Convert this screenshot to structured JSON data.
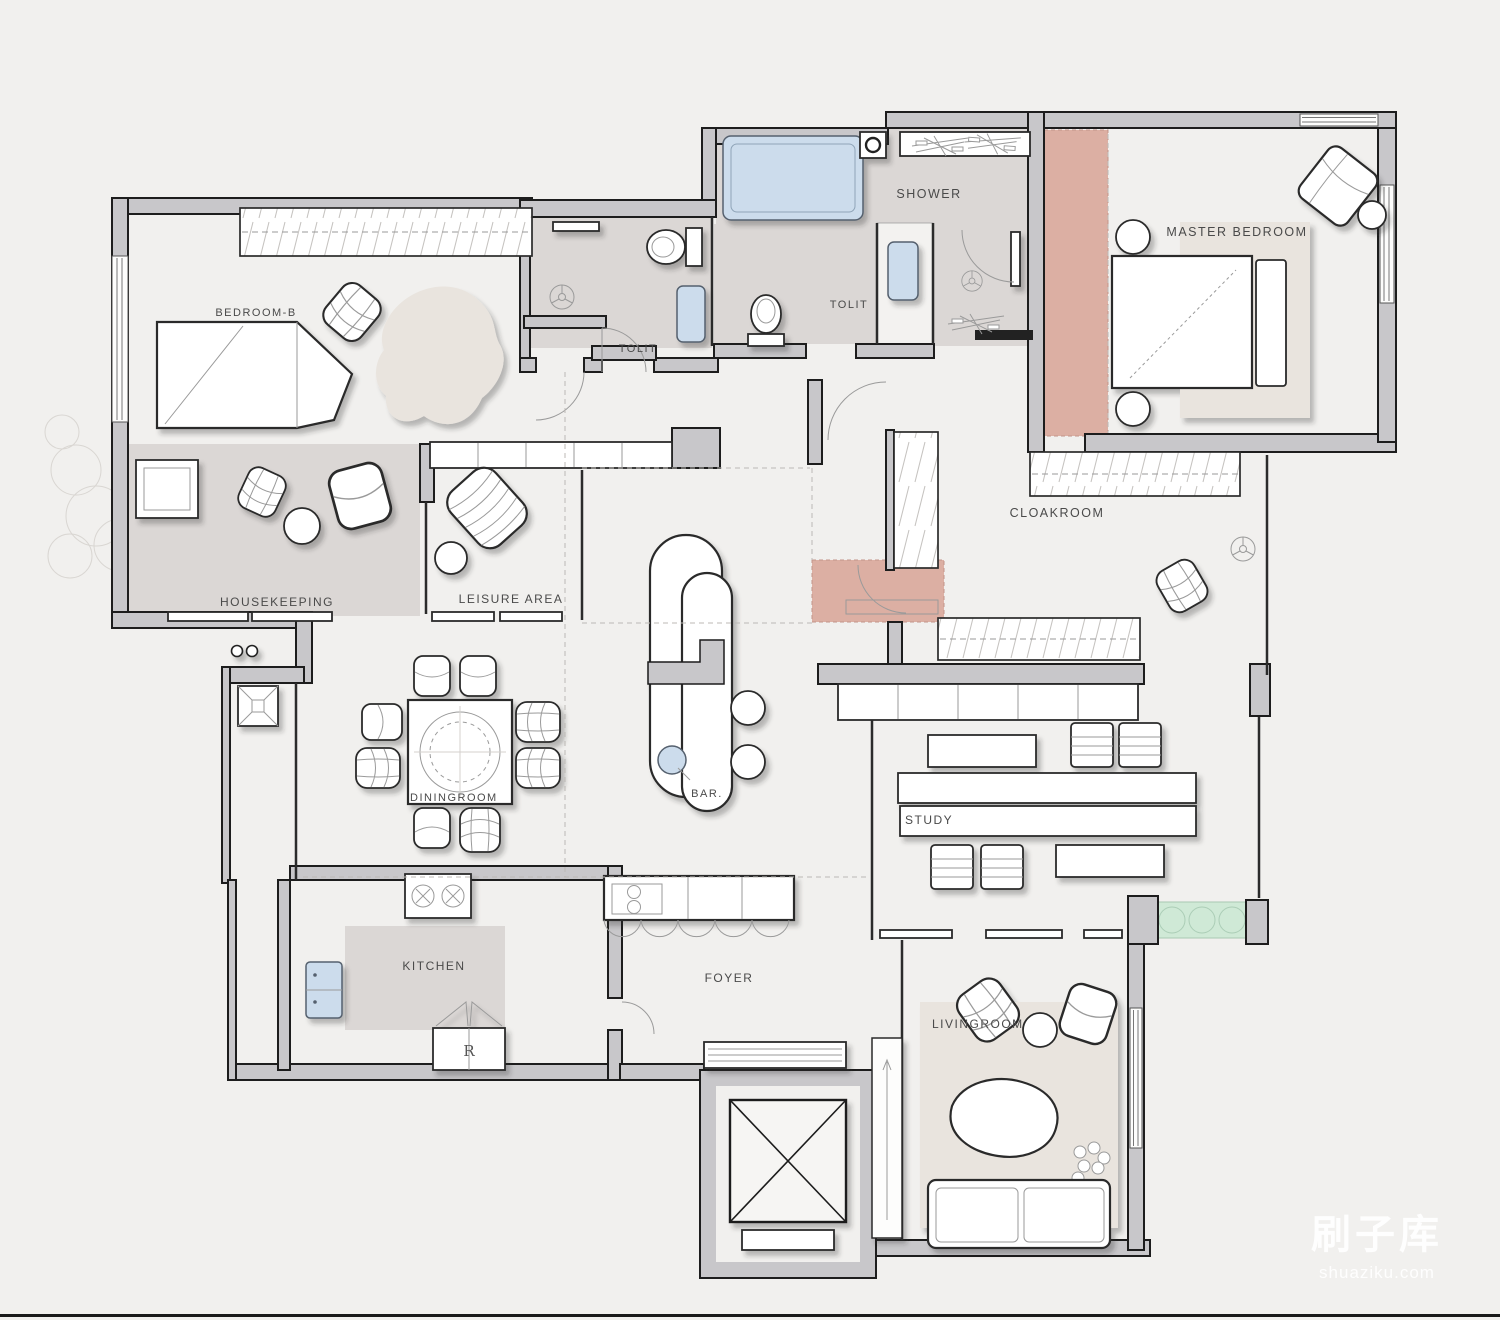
{
  "page": {
    "kind": "apartment-floor-plan",
    "background": "#f1f0ee"
  },
  "watermark": {
    "brand": "刷子库",
    "site": "shuaziku.com"
  },
  "rooms": {
    "bedroom_b": "BEDROOM-B",
    "tolit_a": "TOLIT",
    "tolit_b": "TOLIT",
    "shower": "SHOWER",
    "master_bedroom": "MASTER BEDROOM",
    "housekeeping": "HOUSEKEEPING",
    "leisure_area": "LEISURE AREA",
    "cloakroom": "CLOAKROOM",
    "diningroom": "DININGROOM",
    "bar": "BAR.",
    "study": "STUDY",
    "kitchen": "KITCHEN",
    "foyer": "FOYER",
    "livingroom": "LIVINGROOM"
  },
  "appliances": {
    "refrigerator_label": "R"
  },
  "colors": {
    "background": "#f1f0ee",
    "wall": "#c8c7ca",
    "wall_outline": "#1d1d1d",
    "floor_gray": "#dbd7d5",
    "rug_beige": "#e9e4de",
    "accent_pink": "#dcafa3",
    "fixture_blue": "#ccdcec",
    "plant_green": "#cfe9d6",
    "watermark_white": "#ffffff"
  }
}
